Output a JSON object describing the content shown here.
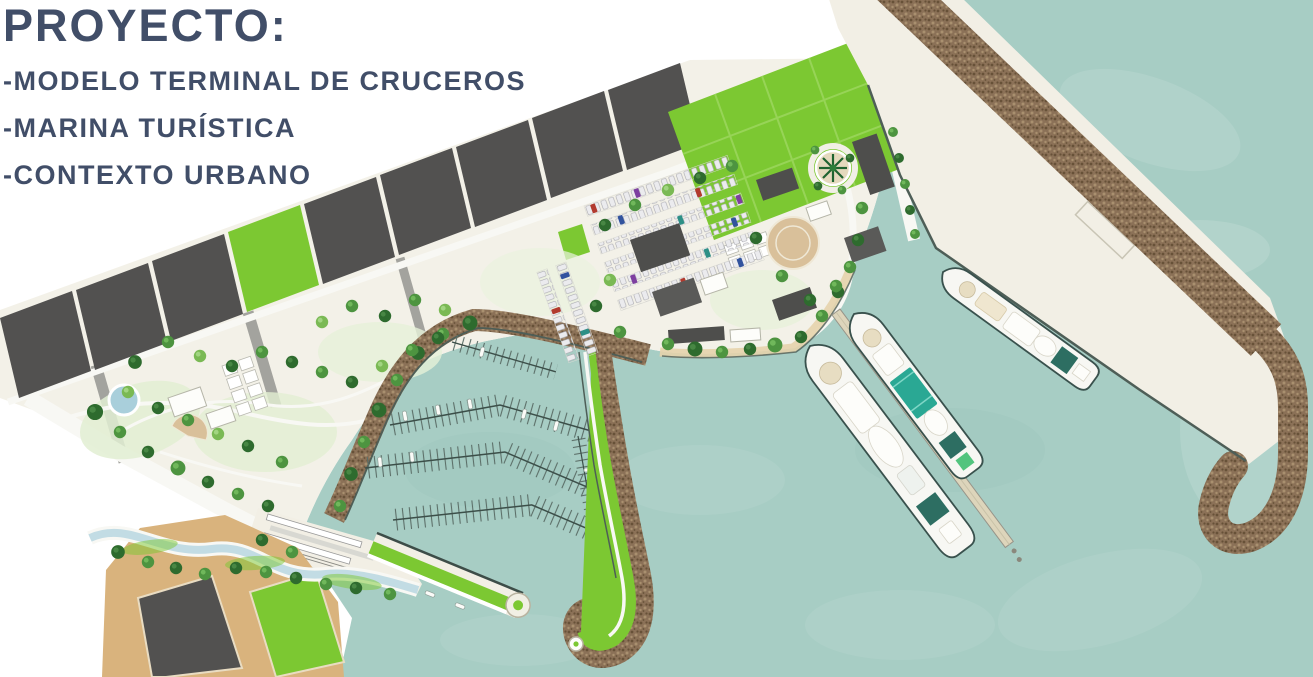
{
  "slide": {
    "title": "PROYECTO:",
    "bullets": [
      "-MODELO TERMINAL DE CRUCEROS",
      "-MARINA TURÍSTICA",
      "-CONTEXTO URBANO"
    ]
  },
  "colors": {
    "title": "#414e68",
    "water": "#a7cdc4",
    "water_light": "#d3e8e1",
    "water_deep": "#7fb0a5",
    "ground": "#f3f1e8",
    "pier": "#f2efe5",
    "rock_base": "#8b7157",
    "rock_dark": "#675138",
    "rock_light": "#a9906f",
    "block_dark": "#525150",
    "lawn": "#7cc832",
    "lawn_line": "#97d457",
    "tree_dark": "#2e6b2e",
    "tree_mid": "#4d9440",
    "tree_light": "#7ab954",
    "sand": "#d9b37d",
    "tan_plaza": "#d9c09a",
    "path_white": "#f8f8f4",
    "road_gray": "#a3a39e",
    "canal": "#c2dce4",
    "quay_line": "#4e5e57",
    "ship_hull": "#f7f7f3",
    "ship_outline": "#39514d",
    "ship_teal": "#2d6e62",
    "ship_green": "#2aa894",
    "cream_deck": "#e7ddc2",
    "building": "#4e4e4c",
    "building2": "#5a5a58"
  }
}
